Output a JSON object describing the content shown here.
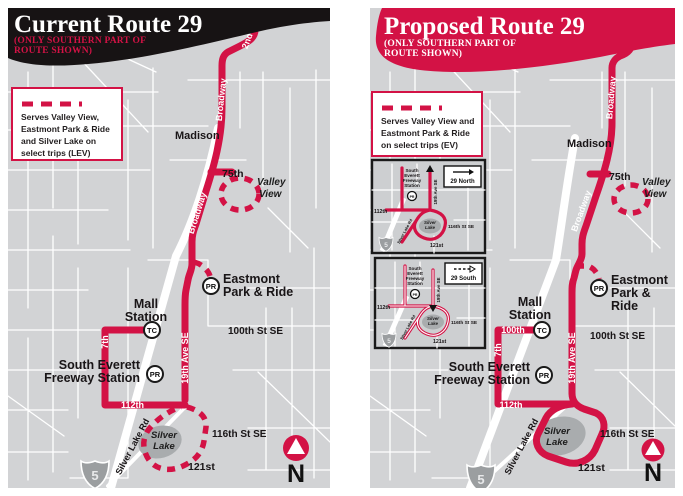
{
  "colors": {
    "route_red": "#d31245",
    "banner_black": "#171314",
    "map_gray": "#d2d3d5",
    "lake_gray": "#a9acae",
    "street_white": "#ffffff"
  },
  "left": {
    "title": "Current Route 29",
    "subtitle1": "(ONLY SOUTHERN PART OF",
    "subtitle2": "ROUTE SHOWN)",
    "legend": {
      "line1": "Serves Valley View,",
      "line2": "Eastmont Park & Ride",
      "line3": "and Silver Lake on",
      "line4": "select trips (LEV)"
    },
    "labels": {
      "second": "2nd",
      "broadway_upper": "Broadway",
      "broadway_lower": "Broadway",
      "madison": "Madison",
      "l75": "75th",
      "valley1": "Valley",
      "valley2": "View",
      "eastmont1": "Eastmont",
      "eastmont2": "Park & Ride",
      "mall1": "Mall",
      "mall2": "Station",
      "st100": "100th St SE",
      "l7": "7th",
      "se1": "South Everett",
      "se2": "Freeway Station",
      "ave19": "19th Ave SE",
      "l112": "112th",
      "st116": "116th St SE",
      "silver1": "Silver",
      "silver2": "Lake",
      "l121": "121st",
      "slrd": "Silver Lake Rd",
      "i5": "5",
      "north": "N",
      "pr": "PR",
      "tc": "TC"
    }
  },
  "right": {
    "title": "Proposed Route 29",
    "subtitle1": "(ONLY SOUTHERN PART OF",
    "subtitle2": "ROUTE SHOWN)",
    "legend": {
      "line1": "Serves Valley View and",
      "line2": "Eastmont Park & Ride",
      "line3": "on select trips (EV)"
    },
    "labels": {
      "l52": "52nd",
      "second": "2nd",
      "broadway_upper": "Broadway",
      "broadway_lower": "Broadway",
      "madison": "Madison",
      "l75": "75th",
      "valley1": "Valley",
      "valley2": "View",
      "eastmont1": "Eastmont",
      "eastmont2": "Park &",
      "eastmont3": "Ride",
      "mall1": "Mall",
      "mall2": "Station",
      "l100": "100th",
      "st100": "100th St SE",
      "l7": "7th",
      "se1": "South Everett",
      "se2": "Freeway Station",
      "ave19": "19th Ave SE",
      "l112": "112th",
      "st116": "116th St SE",
      "silver1": "Silver",
      "silver2": "Lake",
      "l121": "121st",
      "slrd": "Silver Lake Rd",
      "i5": "5",
      "north": "N",
      "pr": "PR",
      "tc": "TC"
    },
    "insets": [
      {
        "badge": "29 North",
        "st1": "South",
        "st2": "Everett",
        "st3": "Freeway",
        "st4": "Station",
        "pr": "PR",
        "l112": "112th",
        "ave19": "19th Ave SE",
        "st116": "116th St SE",
        "silver1": "Silver",
        "silver2": "Lake",
        "l121": "121st",
        "slrd": "Silver Lake Rd",
        "i5": "5"
      },
      {
        "badge": "29 South",
        "st1": "South",
        "st2": "Everett",
        "st3": "Freeway",
        "st4": "Station",
        "pr": "PR",
        "l112": "112th",
        "ave19": "19th Ave SE",
        "st116": "116th St SE",
        "silver1": "Silver",
        "silver2": "Lake",
        "l121": "121st",
        "slrd": "Silver Lake Rd",
        "i5": "5"
      }
    ]
  }
}
